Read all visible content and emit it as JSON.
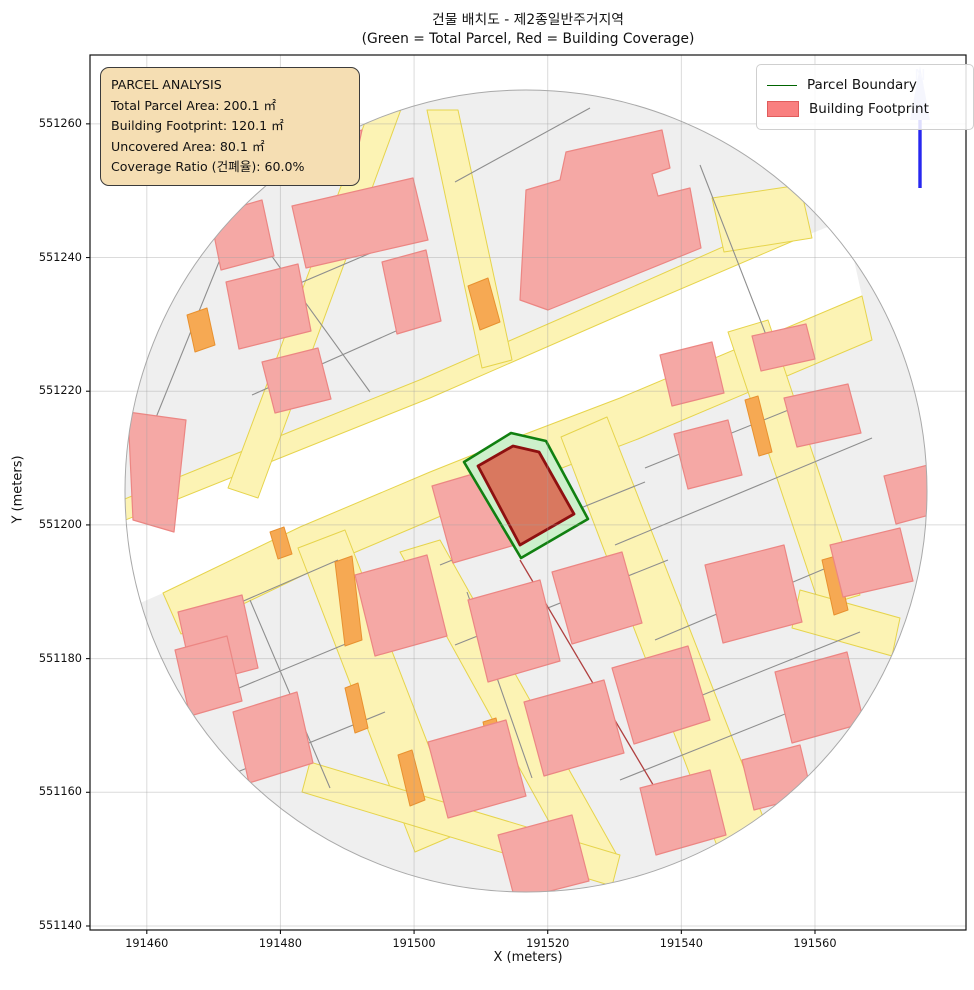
{
  "figure": {
    "title_line1": "건물 배치도 - 제2종일반주거지역",
    "title_line2": "(Green = Total Parcel, Red = Building Coverage)"
  },
  "info_box": {
    "line1": "PARCEL ANALYSIS",
    "line2": "Total Parcel Area: 200.1 ㎡",
    "line3": "Building Footprint: 120.1 ㎡",
    "line4": "Uncovered Area: 80.1 ㎡",
    "line5": "Coverage Ratio (건폐율): 60.0%"
  },
  "legend": {
    "item1": "Parcel Boundary",
    "item2": "Building Footprint"
  },
  "north_label": "N",
  "chart_data": {
    "type": "map",
    "title": "건물 배치도 - 제2종일반주거지역",
    "subtitle": "(Green = Total Parcel, Red = Building Coverage)",
    "xlabel": "X (meters)",
    "ylabel": "Y (meters)",
    "xlim": [
      191451.5,
      191582.6
    ],
    "ylim": [
      551139.4,
      551270.3
    ],
    "x_ticks": [
      191460,
      191480,
      191500,
      191520,
      191540,
      191560
    ],
    "y_ticks": [
      551140,
      551160,
      551180,
      551200,
      551220,
      551240,
      551260
    ],
    "grid": true,
    "legend_position": "upper right",
    "annotation": {
      "total_parcel_area_m2": 200.1,
      "building_footprint_m2": 120.1,
      "uncovered_area_m2": 80.1,
      "coverage_ratio_pct": 60.0
    },
    "parcel_centroid": {
      "x": 191512,
      "y": 551205
    },
    "buffer_radius_m": 60,
    "plot_area": {
      "x": 90,
      "y": 55,
      "w": 876,
      "h": 875
    },
    "colors": {
      "parcel_base": "#efefef",
      "parcel_edge": "#8e8e8e",
      "road_fill": "#fcf3b4",
      "road_edge": "#e6d44c",
      "building_fill": "#f5a8a5",
      "building_edge": "#ec8683",
      "orange_fill": "#f6a953",
      "orange_edge": "#e8912f",
      "white_band": "#ffffff",
      "highlight_parcel_fill": "#cdf0cb",
      "highlight_parcel_edge": "#118011",
      "highlight_building_fill": "#d9785f",
      "highlight_building_edge": "#8e1010",
      "grid_color": "rgba(160,160,160,0.38)",
      "red_line": "#b04040",
      "north_arrow": "#2727f0",
      "north_head": "#bcc2f2",
      "north_text": "#c8cdf5"
    },
    "map": {
      "circle": {
        "cx": 526,
        "cy": 491,
        "r": 401
      },
      "white_band": [
        [
          118,
          523
        ],
        [
          300,
          450
        ],
        [
          430,
          398
        ],
        [
          620,
          315
        ],
        [
          800,
          238
        ],
        [
          845,
          220
        ],
        [
          862,
          296
        ],
        [
          620,
          398
        ],
        [
          515,
          438
        ],
        [
          430,
          472
        ],
        [
          300,
          527
        ],
        [
          163,
          593
        ],
        [
          120,
          612
        ]
      ],
      "roads": [
        [
          [
            110,
            505
          ],
          [
            292,
            431
          ],
          [
            422,
            379
          ],
          [
            612,
            296
          ],
          [
            795,
            215
          ],
          [
            800,
            238
          ],
          [
            620,
            315
          ],
          [
            430,
            398
          ],
          [
            300,
            450
          ],
          [
            118,
            523
          ]
        ],
        [
          [
            163,
            593
          ],
          [
            300,
            527
          ],
          [
            430,
            472
          ],
          [
            515,
            438
          ],
          [
            620,
            398
          ],
          [
            862,
            296
          ],
          [
            872,
            340
          ],
          [
            638,
            439
          ],
          [
            533,
            479
          ],
          [
            448,
            513
          ],
          [
            318,
            568
          ],
          [
            181,
            634
          ]
        ],
        [
          [
            376,
            93
          ],
          [
            407,
            93
          ],
          [
            258,
            498
          ],
          [
            228,
            488
          ]
        ],
        [
          [
            427,
            110
          ],
          [
            458,
            110
          ],
          [
            512,
            360
          ],
          [
            482,
            368
          ]
        ],
        [
          [
            298,
            548
          ],
          [
            345,
            530
          ],
          [
            462,
            832
          ],
          [
            415,
            852
          ]
        ],
        [
          [
            400,
            552
          ],
          [
            440,
            540
          ],
          [
            618,
            857
          ],
          [
            578,
            874
          ]
        ],
        [
          [
            310,
            762
          ],
          [
            620,
            855
          ],
          [
            612,
            886
          ],
          [
            302,
            792
          ]
        ],
        [
          [
            561,
            437
          ],
          [
            607,
            417
          ],
          [
            772,
            840
          ],
          [
            727,
            872
          ]
        ],
        [
          [
            728,
            332
          ],
          [
            768,
            320
          ],
          [
            860,
            595
          ],
          [
            820,
            607
          ]
        ],
        [
          [
            800,
            590
          ],
          [
            900,
            618
          ],
          [
            892,
            656
          ],
          [
            792,
            628
          ]
        ],
        [
          [
            712,
            198
          ],
          [
            800,
            185
          ],
          [
            812,
            238
          ],
          [
            724,
            252
          ]
        ]
      ],
      "parcel_lines": [
        [
          455,
          182,
          590,
          108
        ],
        [
          155,
          420,
          240,
          210
        ],
        [
          237,
          208,
          370,
          392
        ],
        [
          232,
          312,
          420,
          232
        ],
        [
          252,
          395,
          432,
          315
        ],
        [
          700,
          165,
          768,
          340
        ],
        [
          645,
          468,
          838,
          390
        ],
        [
          615,
          545,
          872,
          438
        ],
        [
          655,
          640,
          893,
          540
        ],
        [
          690,
          700,
          860,
          632
        ],
        [
          620,
          780,
          800,
          708
        ],
        [
          440,
          565,
          645,
          482
        ],
        [
          455,
          645,
          668,
          560
        ],
        [
          467,
          592,
          532,
          778
        ],
        [
          195,
          622,
          338,
          560
        ],
        [
          210,
          700,
          360,
          638
        ],
        [
          230,
          775,
          385,
          712
        ],
        [
          250,
          600,
          330,
          788
        ]
      ],
      "red_lines": [
        [
          520,
          560,
          668,
          810
        ]
      ],
      "orange": [
        [
          [
            187,
            315
          ],
          [
            207,
            308
          ],
          [
            215,
            345
          ],
          [
            195,
            352
          ]
        ],
        [
          [
            468,
            286
          ],
          [
            488,
            278
          ],
          [
            500,
            322
          ],
          [
            480,
            330
          ]
        ],
        [
          [
            335,
            562
          ],
          [
            352,
            556
          ],
          [
            362,
            640
          ],
          [
            345,
            646
          ]
        ],
        [
          [
            745,
            400
          ],
          [
            758,
            396
          ],
          [
            772,
            452
          ],
          [
            759,
            456
          ]
        ],
        [
          [
            822,
            560
          ],
          [
            836,
            556
          ],
          [
            848,
            610
          ],
          [
            834,
            615
          ]
        ],
        [
          [
            270,
            532
          ],
          [
            284,
            527
          ],
          [
            292,
            554
          ],
          [
            278,
            559
          ]
        ],
        [
          [
            345,
            688
          ],
          [
            358,
            683
          ],
          [
            368,
            728
          ],
          [
            355,
            733
          ]
        ],
        [
          [
            398,
            755
          ],
          [
            412,
            750
          ],
          [
            425,
            800
          ],
          [
            410,
            806
          ]
        ],
        [
          [
            408,
            574
          ],
          [
            420,
            570
          ],
          [
            428,
            592
          ],
          [
            416,
            596
          ]
        ],
        [
          [
            483,
            722
          ],
          [
            496,
            718
          ],
          [
            506,
            764
          ],
          [
            493,
            768
          ]
        ]
      ],
      "buildings": [
        [
          [
            128,
            412
          ],
          [
            186,
            420
          ],
          [
            174,
            532
          ],
          [
            133,
            520
          ]
        ],
        [
          [
            210,
            215
          ],
          [
            262,
            200
          ],
          [
            274,
            256
          ],
          [
            221,
            270
          ]
        ],
        [
          [
            292,
            206
          ],
          [
            413,
            178
          ],
          [
            428,
            240
          ],
          [
            306,
            268
          ]
        ],
        [
          [
            325,
            142
          ],
          [
            362,
            130
          ],
          [
            353,
            172
          ],
          [
            323,
            176
          ]
        ],
        [
          [
            226,
            282
          ],
          [
            298,
            264
          ],
          [
            311,
            331
          ],
          [
            239,
            349
          ]
        ],
        [
          [
            262,
            362
          ],
          [
            318,
            348
          ],
          [
            331,
            399
          ],
          [
            275,
            413
          ]
        ],
        [
          [
            382,
            262
          ],
          [
            426,
            250
          ],
          [
            441,
            321
          ],
          [
            397,
            334
          ]
        ],
        [
          [
            520,
            300
          ],
          [
            526,
            190
          ],
          [
            560,
            180
          ],
          [
            566,
            152
          ],
          [
            662,
            130
          ],
          [
            670,
            168
          ],
          [
            652,
            174
          ],
          [
            658,
            196
          ],
          [
            690,
            188
          ],
          [
            701,
            248
          ],
          [
            548,
            310
          ]
        ],
        [
          [
            660,
            355
          ],
          [
            712,
            342
          ],
          [
            724,
            393
          ],
          [
            672,
            406
          ]
        ],
        [
          [
            752,
            336
          ],
          [
            806,
            324
          ],
          [
            815,
            359
          ],
          [
            761,
            371
          ]
        ],
        [
          [
            784,
            398
          ],
          [
            848,
            384
          ],
          [
            861,
            433
          ],
          [
            797,
            447
          ]
        ],
        [
          [
            830,
            545
          ],
          [
            900,
            528
          ],
          [
            913,
            581
          ],
          [
            843,
            597
          ]
        ],
        [
          [
            884,
            476
          ],
          [
            936,
            463
          ],
          [
            948,
            510
          ],
          [
            896,
            524
          ]
        ],
        [
          [
            674,
            434
          ],
          [
            728,
            420
          ],
          [
            742,
            475
          ],
          [
            688,
            489
          ]
        ],
        [
          [
            705,
            565
          ],
          [
            784,
            545
          ],
          [
            802,
            622
          ],
          [
            723,
            643
          ]
        ],
        [
          [
            640,
            788
          ],
          [
            710,
            770
          ],
          [
            726,
            835
          ],
          [
            656,
            855
          ]
        ],
        [
          [
            432,
            486
          ],
          [
            500,
            466
          ],
          [
            522,
            543
          ],
          [
            453,
            563
          ]
        ],
        [
          [
            552,
            572
          ],
          [
            622,
            552
          ],
          [
            642,
            623
          ],
          [
            572,
            644
          ]
        ],
        [
          [
            468,
            600
          ],
          [
            540,
            580
          ],
          [
            560,
            661
          ],
          [
            488,
            682
          ]
        ],
        [
          [
            524,
            702
          ],
          [
            604,
            680
          ],
          [
            624,
            753
          ],
          [
            544,
            776
          ]
        ],
        [
          [
            612,
            668
          ],
          [
            688,
            646
          ],
          [
            710,
            720
          ],
          [
            634,
            744
          ]
        ],
        [
          [
            428,
            742
          ],
          [
            506,
            720
          ],
          [
            526,
            796
          ],
          [
            448,
            818
          ]
        ],
        [
          [
            178,
            612
          ],
          [
            242,
            595
          ],
          [
            258,
            668
          ],
          [
            194,
            685
          ]
        ],
        [
          [
            355,
            575
          ],
          [
            427,
            555
          ],
          [
            447,
            636
          ],
          [
            375,
            656
          ]
        ],
        [
          [
            175,
            650
          ],
          [
            227,
            636
          ],
          [
            242,
            701
          ],
          [
            190,
            716
          ]
        ],
        [
          [
            233,
            712
          ],
          [
            297,
            692
          ],
          [
            313,
            763
          ],
          [
            249,
            783
          ]
        ],
        [
          [
            498,
            835
          ],
          [
            572,
            815
          ],
          [
            589,
            881
          ],
          [
            515,
            900
          ]
        ],
        [
          [
            775,
            672
          ],
          [
            847,
            652
          ],
          [
            864,
            723
          ],
          [
            792,
            743
          ]
        ],
        [
          [
            742,
            760
          ],
          [
            800,
            745
          ],
          [
            812,
            795
          ],
          [
            754,
            810
          ]
        ]
      ],
      "highlight_parcel": [
        [
          464,
          462
        ],
        [
          511,
          433
        ],
        [
          546,
          441
        ],
        [
          588,
          519
        ],
        [
          521,
          558
        ]
      ],
      "highlight_building": [
        [
          478,
          466
        ],
        [
          513,
          446
        ],
        [
          539,
          452
        ],
        [
          574,
          514
        ],
        [
          520,
          545
        ]
      ]
    }
  }
}
